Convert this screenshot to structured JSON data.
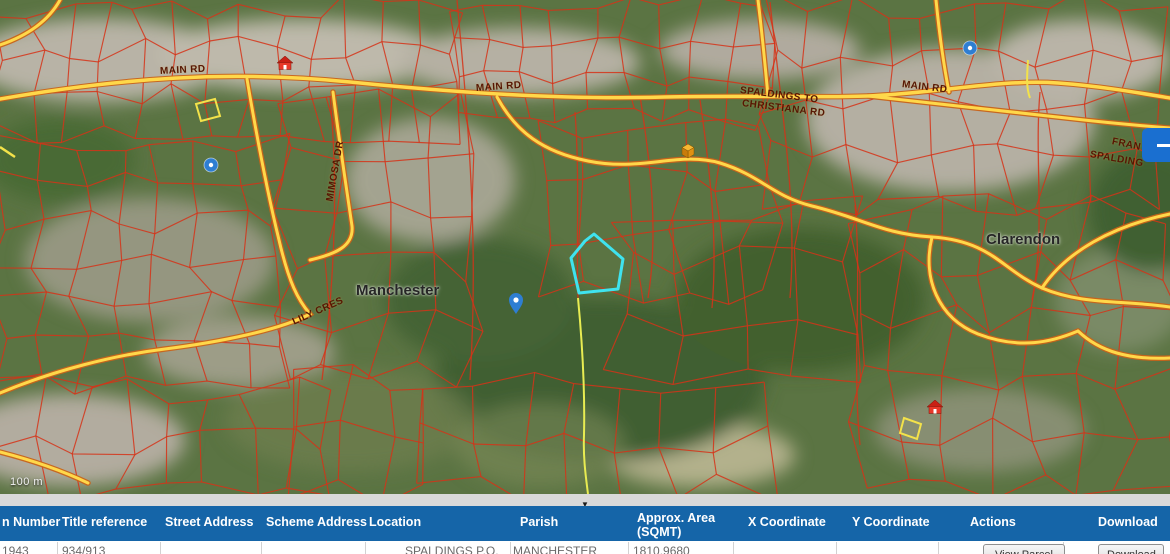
{
  "map": {
    "scale_label": "100 m",
    "place_labels": [
      {
        "name": "manchester",
        "text": "Manchester",
        "x": 356,
        "y": 282,
        "rot": 0
      },
      {
        "name": "clarendon",
        "text": "Clarendon",
        "x": 986,
        "y": 231,
        "rot": 0
      }
    ],
    "road_labels": [
      {
        "text": "MAIN RD",
        "x": 160,
        "y": 66,
        "rot": -3
      },
      {
        "text": "MAIN RD",
        "x": 476,
        "y": 83,
        "rot": -4
      },
      {
        "text": "MAIN RD",
        "x": 902,
        "y": 79,
        "rot": 7
      },
      {
        "text": "SPALDINGS TO",
        "x": 740,
        "y": 85,
        "rot": 7
      },
      {
        "text": "CHRISTIANA  RD",
        "x": 742,
        "y": 98,
        "rot": 7
      },
      {
        "text": "MIMOSA DR",
        "x": 330,
        "y": 196,
        "rot": -80
      },
      {
        "text": "LILY CRES",
        "x": 293,
        "y": 317,
        "rot": -24
      },
      {
        "text": "FRAN",
        "x": 1112,
        "y": 136,
        "rot": 12
      },
      {
        "text": "SPALDING",
        "x": 1090,
        "y": 149,
        "rot": 10
      }
    ],
    "circle_pins": [
      {
        "x": 211,
        "y": 165
      },
      {
        "x": 970,
        "y": 48
      }
    ],
    "drop_pins": [
      {
        "x": 516,
        "y": 299
      }
    ],
    "house_icons": [
      {
        "x": 285,
        "y": 63
      },
      {
        "x": 935,
        "y": 407
      }
    ],
    "building_icons": [
      {
        "x": 688,
        "y": 151
      }
    ],
    "colors": {
      "parcel": "#d63318",
      "road_fill": "#ffd84a",
      "road_casing": "#c9641a",
      "highlight": "#3fe3ef",
      "pin_blue": "#2e7ed2"
    }
  },
  "collapse_button": {
    "icon": "minus"
  },
  "divider": {
    "arrow": "▼"
  },
  "table": {
    "header_bg": "#1565a8",
    "columns": [
      "n Number",
      "Title reference",
      "Street Address",
      "Scheme Address",
      "Location",
      "Parish",
      "Approx. Area",
      "X Coordinate",
      "Y Coordinate",
      "Actions",
      "Download"
    ],
    "area_unit_label": "(SQMT)",
    "row": [
      "1943",
      "934/913",
      "",
      "",
      "SPALDINGS P.O.",
      "MANCHESTER",
      "1810.9680",
      "",
      ""
    ],
    "buttons": {
      "view": "View Parcel",
      "download": "Download"
    }
  }
}
